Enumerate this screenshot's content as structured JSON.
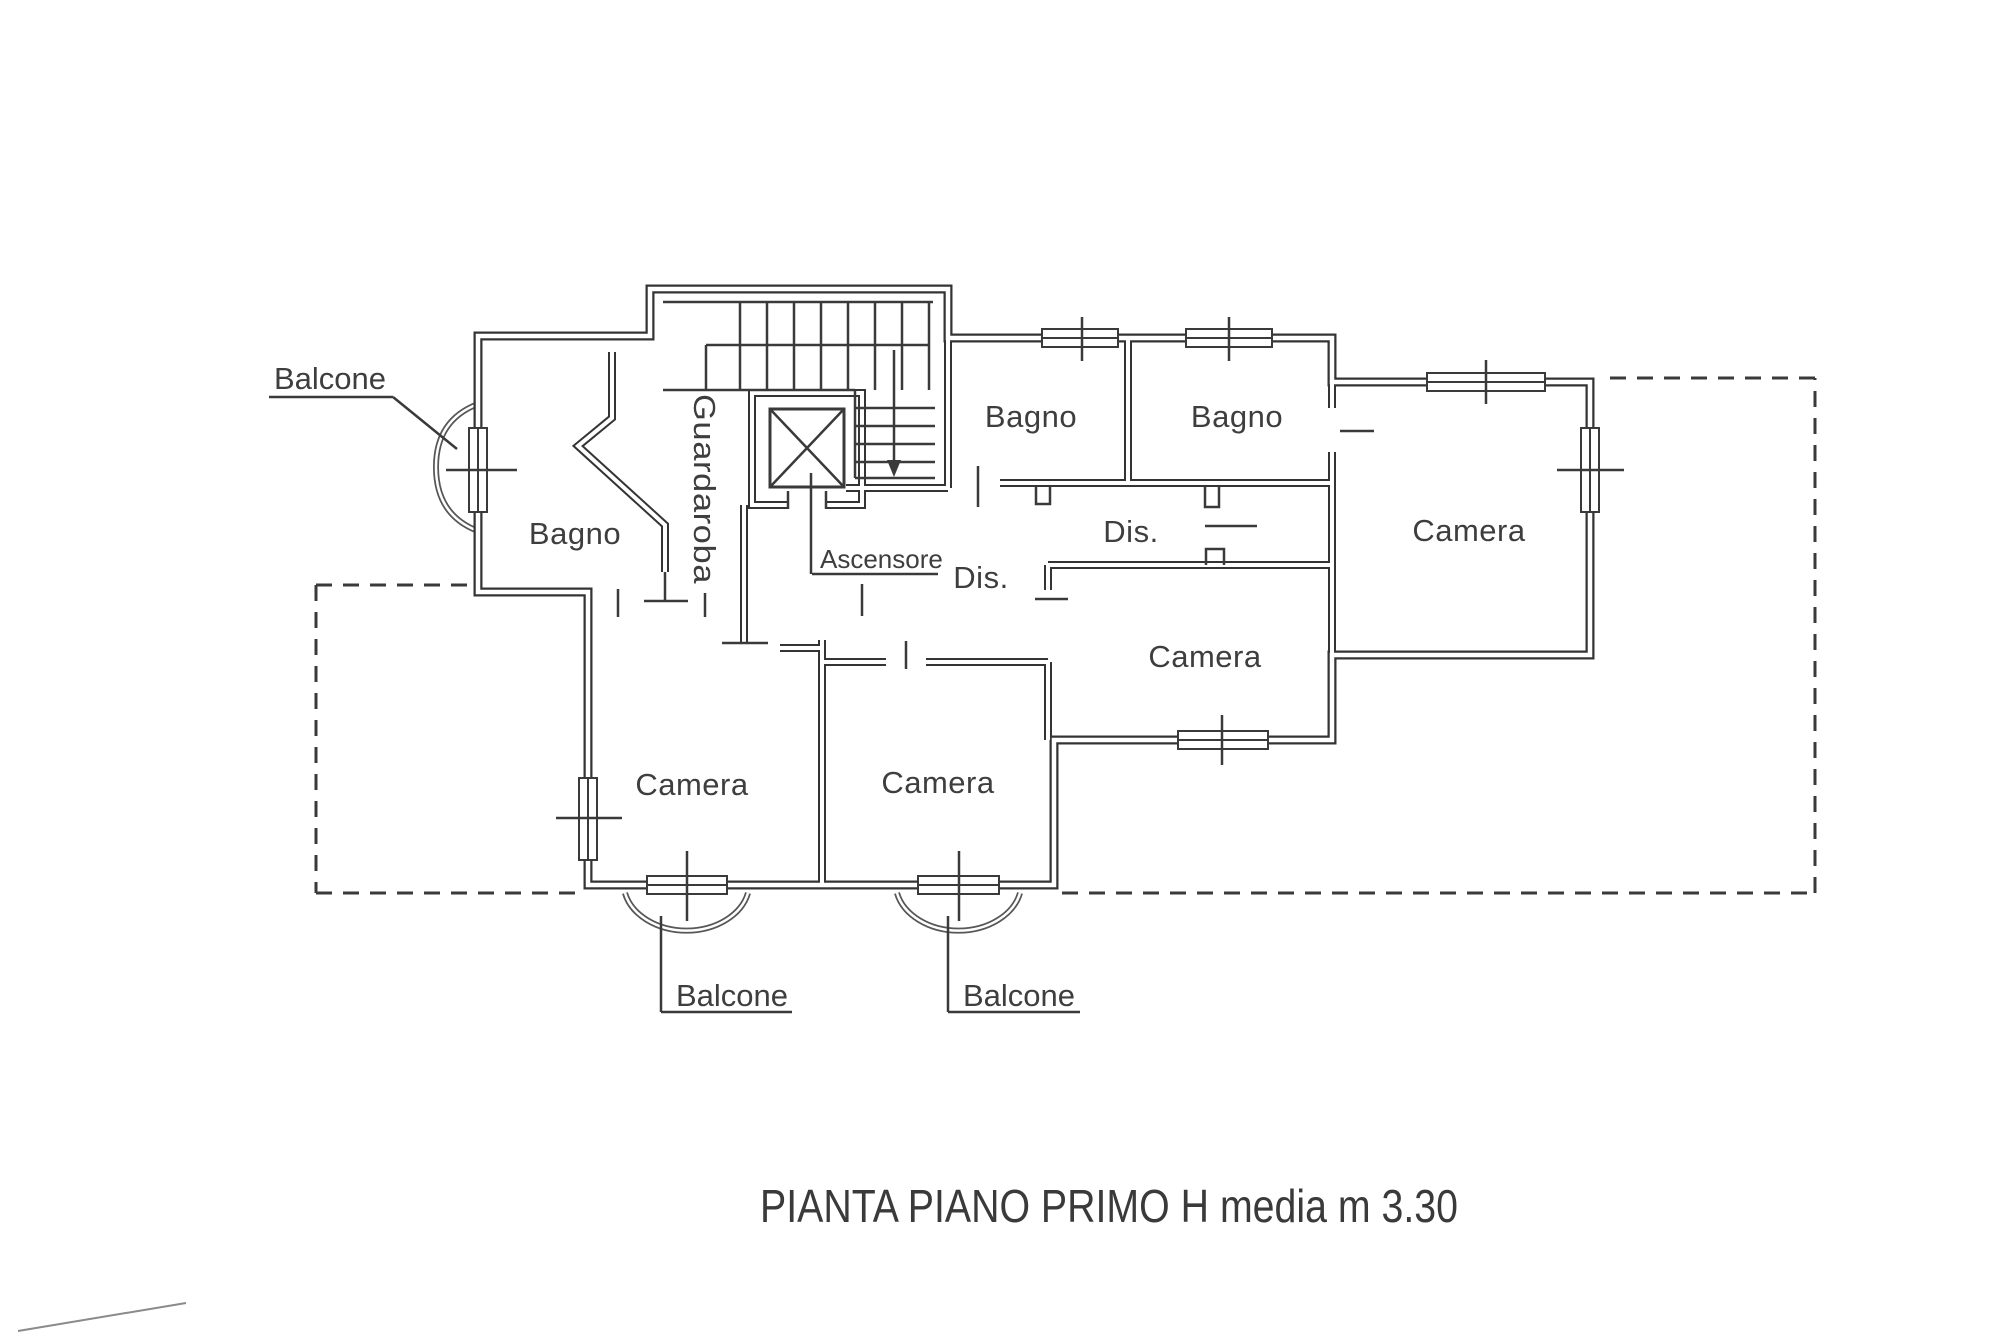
{
  "page": {
    "caption": "PIANTA PIANO PRIMO H media m 3.30"
  },
  "plan": {
    "rooms": {
      "bagno_left": "Bagno",
      "bagno_middle": "Bagno",
      "bagno_right": "Bagno",
      "guardaroba": "Guardaroba",
      "ascensore": "Ascensore",
      "dis_upper": "Dis.",
      "dis_lower": "Dis.",
      "camera_right": "Camera",
      "camera_middle": "Camera",
      "camera_bottom_left": "Camera",
      "camera_bottom_middle": "Camera"
    },
    "balconies": {
      "top_left": "Balcone",
      "bottom_left": "Balcone",
      "bottom_middle": "Balcone"
    },
    "colors": {
      "ink": "#3a3a3a",
      "paper": "#ffffff",
      "balcony_line": "#575757"
    }
  }
}
